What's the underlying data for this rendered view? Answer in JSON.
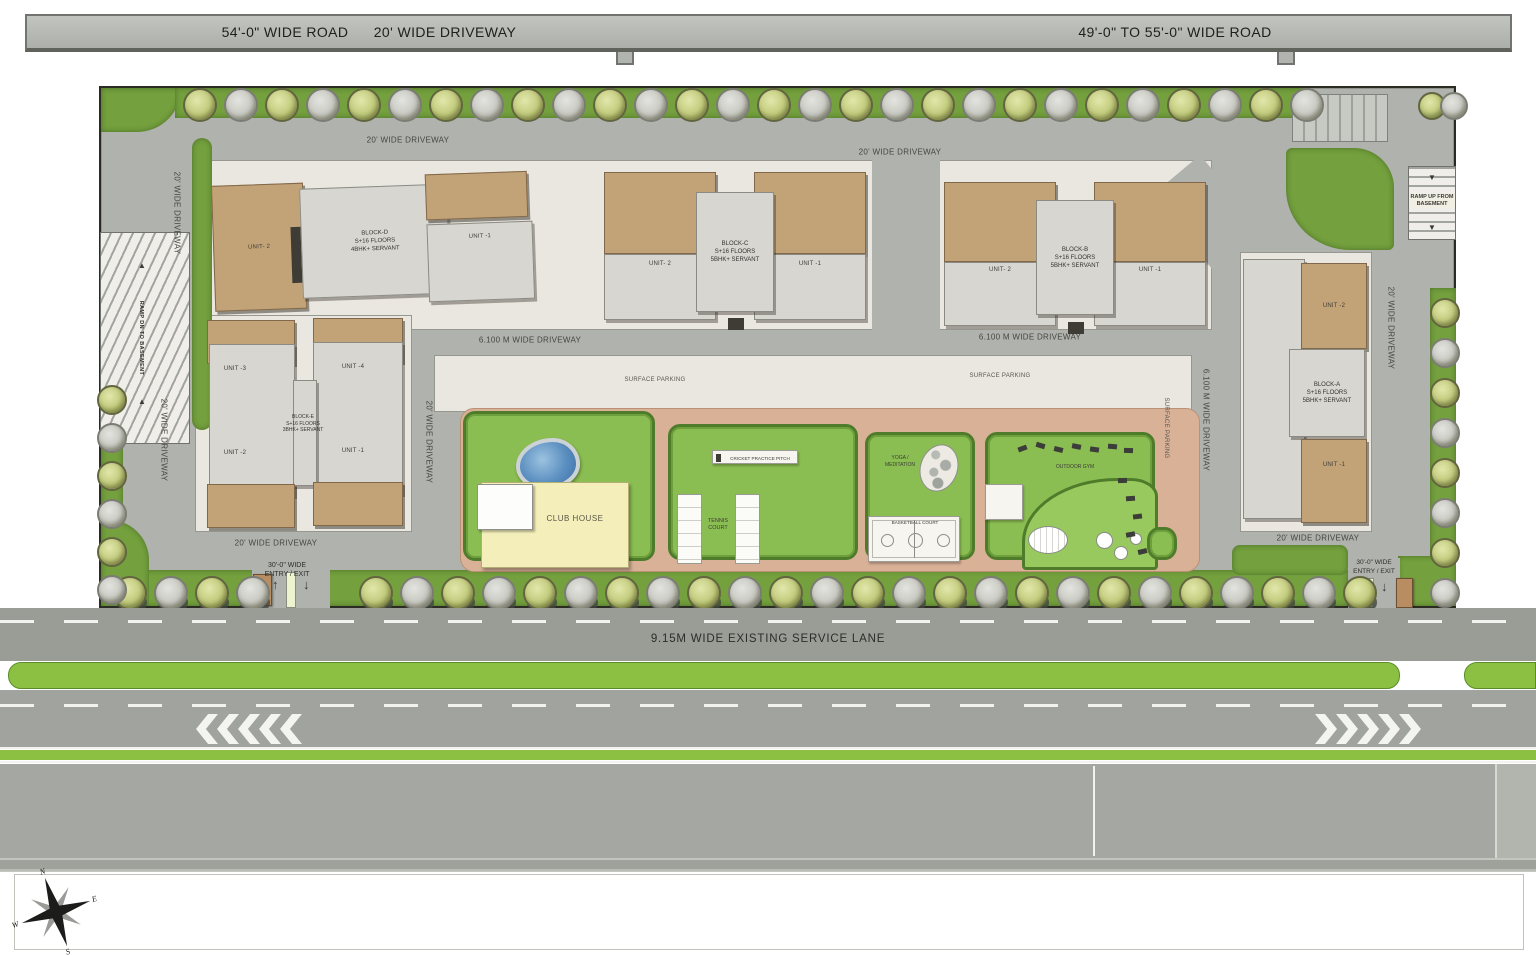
{
  "top_bar": {
    "road_left_label": "54'-0\" WIDE ROAD",
    "driveway_label": "20' WIDE DRIVEWAY",
    "road_right_label": "49'-0\" TO 55'-0\" WIDE ROAD"
  },
  "site": {
    "blocks": [
      {
        "name": "BLOCK-D",
        "floors": "S+16 FLOORS",
        "config": "4BHK+ SERVANT",
        "unit_left": "UNIT- 2",
        "unit_right": "UNIT -1"
      },
      {
        "name": "BLOCK-C",
        "floors": "S+16 FLOORS",
        "config": "5BHK+ SERVANT",
        "unit_left": "UNIT- 2",
        "unit_right": "UNIT -1"
      },
      {
        "name": "BLOCK-B",
        "floors": "S+16 FLOORS",
        "config": "5BHK+ SERVANT",
        "unit_left": "UNIT- 2",
        "unit_right": "UNIT -1"
      },
      {
        "name": "BLOCK-A",
        "floors": "S+16 FLOORS",
        "config": "5BHK+ SERVANT",
        "unit_top": "UNIT -2",
        "unit_bottom": "UNIT -1"
      },
      {
        "name": "BLOCK-E",
        "floors": "S+16 FLOORS",
        "config": "3BHK+ SERVANT",
        "unit_tl": "UNIT -3",
        "unit_tr": "UNIT -4",
        "unit_bl": "UNIT -2",
        "unit_br": "UNIT -1"
      }
    ],
    "amenities": {
      "club_house": "CLUB HOUSE",
      "tennis_line1": "TENNIS",
      "tennis_line2": "COURT",
      "cricket": "CRICKET PRACTICE PITCH",
      "basketball": "BASKETBALL COURT",
      "yoga_line1": "YOGA /",
      "yoga_line2": "MEDITATION",
      "outdoor_gym": "OUTDOOR GYM"
    },
    "ramps": {
      "down": "RAMP DN TO BASEMENT",
      "up_line1": "RAMP UP FROM",
      "up_line2": "BASEMENT"
    },
    "entry": {
      "line1": "30'-0\" WIDE",
      "line2": "ENTRY / EXIT"
    },
    "plan_labels": [
      {
        "text": "20' WIDE DRIVEWAY",
        "x": 408,
        "y": 140,
        "rot": 0,
        "cls": ""
      },
      {
        "text": "20' WIDE DRIVEWAY",
        "x": 900,
        "y": 152,
        "rot": 0,
        "cls": ""
      },
      {
        "text": "20' WIDE DRIVEWAY",
        "x": 177,
        "y": 213,
        "rot": 90,
        "cls": ""
      },
      {
        "text": "20' WIDE DRIVEWAY",
        "x": 164,
        "y": 440,
        "rot": 90,
        "cls": ""
      },
      {
        "text": "20' WIDE DRIVEWAY",
        "x": 276,
        "y": 543,
        "rot": 0,
        "cls": ""
      },
      {
        "text": "20' WIDE DRIVEWAY",
        "x": 1318,
        "y": 538,
        "rot": 0,
        "cls": ""
      },
      {
        "text": "20' WIDE DRIVEWAY",
        "x": 1391,
        "y": 328,
        "rot": 90,
        "cls": ""
      },
      {
        "text": "20' WIDE DRIVEWAY",
        "x": 429,
        "y": 442,
        "rot": 90,
        "cls": ""
      },
      {
        "text": "6.100 M WIDE DRIVEWAY",
        "x": 530,
        "y": 340,
        "rot": 0,
        "cls": ""
      },
      {
        "text": "6.100 M WIDE DRIVEWAY",
        "x": 1030,
        "y": 337,
        "rot": 0,
        "cls": ""
      },
      {
        "text": "6.100 M WIDE DRIVEWAY",
        "x": 1206,
        "y": 420,
        "rot": 90,
        "cls": ""
      },
      {
        "text": "SURFACE PARKING",
        "x": 655,
        "y": 380,
        "rot": 0,
        "cls": "lab-park"
      },
      {
        "text": "SURFACE PARKING",
        "x": 1000,
        "y": 376,
        "rot": 0,
        "cls": "lab-park"
      },
      {
        "text": "SURFACE PARKING",
        "x": 1166,
        "y": 428,
        "rot": 90,
        "cls": "lab-park"
      }
    ]
  },
  "roads": {
    "service_lane_label": "9.15M WIDE EXISTING SERVICE LANE"
  },
  "compass": {
    "n": "N",
    "e": "E",
    "s": "S",
    "w": "W"
  }
}
